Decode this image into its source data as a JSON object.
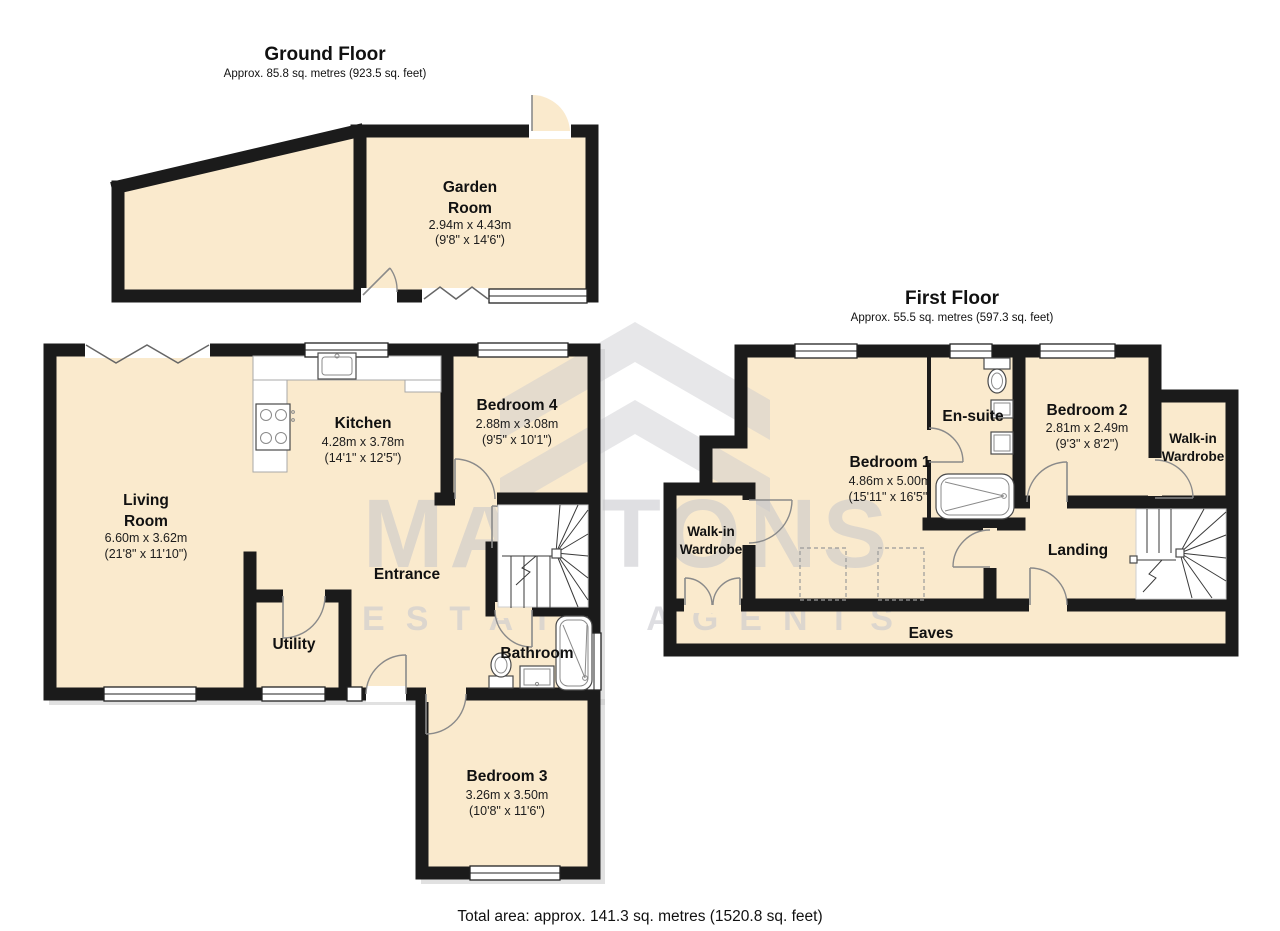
{
  "ground_floor": {
    "title": "Ground Floor",
    "area_note": "Approx. 85.8 sq. metres (923.5 sq. feet)",
    "rooms": {
      "garden_room": {
        "name_line1": "Garden",
        "name_line2": "Room",
        "size_metric": "2.94m x 4.43m",
        "size_imperial": "(9'8\" x 14'6\")"
      },
      "living_room": {
        "name_line1": "Living",
        "name_line2": "Room",
        "size_metric": "6.60m x 3.62m",
        "size_imperial": "(21'8\" x 11'10\")"
      },
      "kitchen": {
        "name": "Kitchen",
        "size_metric": "4.28m x 3.78m",
        "size_imperial": "(14'1\" x 12'5\")"
      },
      "bedroom_4": {
        "name": "Bedroom 4",
        "size_metric": "2.88m x 3.08m",
        "size_imperial": "(9'5\" x 10'1\")"
      },
      "bedroom_3": {
        "name": "Bedroom 3",
        "size_metric": "3.26m x 3.50m",
        "size_imperial": "(10'8\" x 11'6\")"
      },
      "entrance": {
        "name": "Entrance"
      },
      "utility": {
        "name": "Utility"
      },
      "bathroom": {
        "name": "Bathroom"
      }
    }
  },
  "first_floor": {
    "title": "First Floor",
    "area_note": "Approx. 55.5 sq. metres (597.3 sq. feet)",
    "rooms": {
      "bedroom_1": {
        "name": "Bedroom 1",
        "size_metric": "4.86m x 5.00m",
        "size_imperial": "(15'11\" x 16'5\")"
      },
      "bedroom_2": {
        "name": "Bedroom 2",
        "size_metric": "2.81m x 2.49m",
        "size_imperial": "(9'3\" x 8'2\")"
      },
      "en_suite": {
        "name": "En-suite"
      },
      "walk_in_wardrobe_left": {
        "name_line1": "Walk-in",
        "name_line2": "Wardrobe"
      },
      "walk_in_wardrobe_right": {
        "name_line1": "Walk-in",
        "name_line2": "Wardrobe"
      },
      "landing": {
        "name": "Landing"
      },
      "eaves": {
        "name": "Eaves"
      }
    }
  },
  "footer": {
    "total_area": "Total area: approx. 141.3 sq. metres (1520.8 sq. feet)"
  },
  "watermark": {
    "brand": "MANTONS",
    "tagline": "ESTATE AGENTS"
  },
  "colors": {
    "floor_fill": "#FAEACD",
    "wall": "#1B1B1B",
    "watermark_grey": "#C9C9CF"
  }
}
